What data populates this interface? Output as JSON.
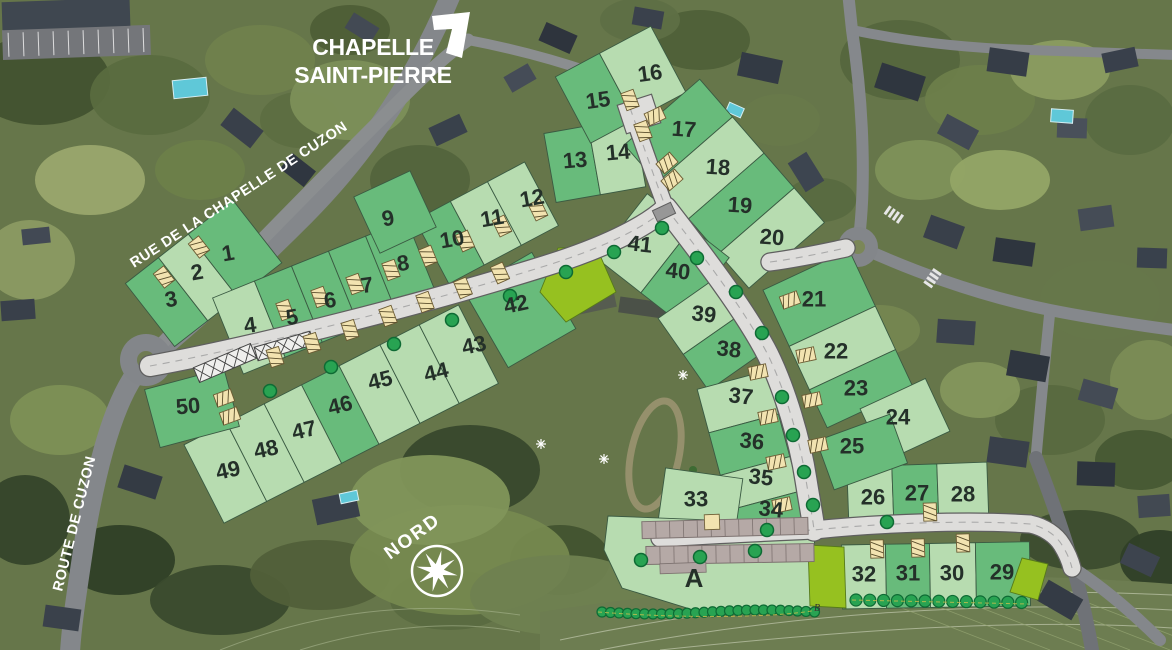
{
  "labels": {
    "chapelle_line1": "CHAPELLE",
    "chapelle_line2": "SAINT-PIERRE",
    "rue_de_la_chapelle": "RUE DE LA CHAPELLE DE CUZON",
    "route_de_cuzon": "ROUTE DE CUZON",
    "nord": "NORD"
  },
  "colors": {
    "lot_dark": "#68bb7b",
    "lot_light": "#b7dcb0",
    "lot_reserved": "#96c120",
    "road_fill": "#dedddb",
    "road_edge": "#5f5f5f",
    "tree_green": "#28a352",
    "tree_edge": "#0e6b34",
    "lot_number": "#243029",
    "driveway_marker": "#f2e3b0",
    "marker_edge": "#6b5b33",
    "building_gray": "#b5a9a6",
    "label_white": "#ffffff"
  },
  "lots": [
    {
      "n": "1",
      "x": 228,
      "y": 253,
      "shade": "dark"
    },
    {
      "n": "2",
      "x": 197,
      "y": 272,
      "shade": "light"
    },
    {
      "n": "3",
      "x": 171,
      "y": 299,
      "shade": "dark"
    },
    {
      "n": "4",
      "x": 250,
      "y": 325,
      "shade": "light"
    },
    {
      "n": "5",
      "x": 292,
      "y": 317,
      "shade": "dark"
    },
    {
      "n": "6",
      "x": 330,
      "y": 300,
      "shade": "dark"
    },
    {
      "n": "7",
      "x": 367,
      "y": 285,
      "shade": "dark"
    },
    {
      "n": "8",
      "x": 403,
      "y": 263,
      "shade": "dark"
    },
    {
      "n": "9",
      "x": 388,
      "y": 218,
      "shade": "dark"
    },
    {
      "n": "10",
      "x": 452,
      "y": 239,
      "shade": "dark"
    },
    {
      "n": "11",
      "x": 492,
      "y": 218,
      "shade": "light"
    },
    {
      "n": "12",
      "x": 532,
      "y": 198,
      "shade": "light"
    },
    {
      "n": "13",
      "x": 575,
      "y": 160,
      "shade": "dark"
    },
    {
      "n": "14",
      "x": 618,
      "y": 152,
      "shade": "light"
    },
    {
      "n": "15",
      "x": 598,
      "y": 100,
      "shade": "dark"
    },
    {
      "n": "16",
      "x": 650,
      "y": 73,
      "shade": "light"
    },
    {
      "n": "17",
      "x": 684,
      "y": 129,
      "shade": "dark"
    },
    {
      "n": "18",
      "x": 718,
      "y": 167,
      "shade": "light"
    },
    {
      "n": "19",
      "x": 740,
      "y": 205,
      "shade": "dark"
    },
    {
      "n": "20",
      "x": 772,
      "y": 237,
      "shade": "light"
    },
    {
      "n": "21",
      "x": 814,
      "y": 299,
      "shade": "dark"
    },
    {
      "n": "22",
      "x": 836,
      "y": 351,
      "shade": "light"
    },
    {
      "n": "23",
      "x": 856,
      "y": 388,
      "shade": "dark"
    },
    {
      "n": "24",
      "x": 898,
      "y": 417,
      "shade": "light"
    },
    {
      "n": "25",
      "x": 852,
      "y": 446,
      "shade": "dark"
    },
    {
      "n": "26",
      "x": 873,
      "y": 497,
      "shade": "light"
    },
    {
      "n": "27",
      "x": 917,
      "y": 493,
      "shade": "dark"
    },
    {
      "n": "28",
      "x": 963,
      "y": 494,
      "shade": "light"
    },
    {
      "n": "29",
      "x": 1002,
      "y": 572,
      "shade": "dark"
    },
    {
      "n": "30",
      "x": 952,
      "y": 573,
      "shade": "light"
    },
    {
      "n": "31",
      "x": 908,
      "y": 573,
      "shade": "dark"
    },
    {
      "n": "32",
      "x": 864,
      "y": 574,
      "shade": "light"
    },
    {
      "n": "33",
      "x": 696,
      "y": 499,
      "shade": "light"
    },
    {
      "n": "34",
      "x": 771,
      "y": 509,
      "shade": "dark"
    },
    {
      "n": "35",
      "x": 761,
      "y": 477,
      "shade": "light"
    },
    {
      "n": "36",
      "x": 752,
      "y": 441,
      "shade": "dark"
    },
    {
      "n": "37",
      "x": 741,
      "y": 396,
      "shade": "light"
    },
    {
      "n": "38",
      "x": 729,
      "y": 349,
      "shade": "dark"
    },
    {
      "n": "39",
      "x": 704,
      "y": 314,
      "shade": "light"
    },
    {
      "n": "40",
      "x": 678,
      "y": 271,
      "shade": "dark"
    },
    {
      "n": "41",
      "x": 640,
      "y": 244,
      "shade": "light"
    },
    {
      "n": "42",
      "x": 516,
      "y": 304,
      "shade": "dark"
    },
    {
      "n": "43",
      "x": 474,
      "y": 345,
      "shade": "light"
    },
    {
      "n": "44",
      "x": 436,
      "y": 372,
      "shade": "light"
    },
    {
      "n": "45",
      "x": 380,
      "y": 380,
      "shade": "light"
    },
    {
      "n": "46",
      "x": 340,
      "y": 405,
      "shade": "dark"
    },
    {
      "n": "47",
      "x": 304,
      "y": 430,
      "shade": "light"
    },
    {
      "n": "48",
      "x": 266,
      "y": 449,
      "shade": "light"
    },
    {
      "n": "49",
      "x": 228,
      "y": 470,
      "shade": "light"
    },
    {
      "n": "50",
      "x": 188,
      "y": 406,
      "shade": "dark"
    },
    {
      "n": "A",
      "x": 694,
      "y": 578,
      "shade": "light"
    }
  ],
  "minor_labels": [
    {
      "text": "B",
      "x": 817,
      "y": 611
    }
  ]
}
